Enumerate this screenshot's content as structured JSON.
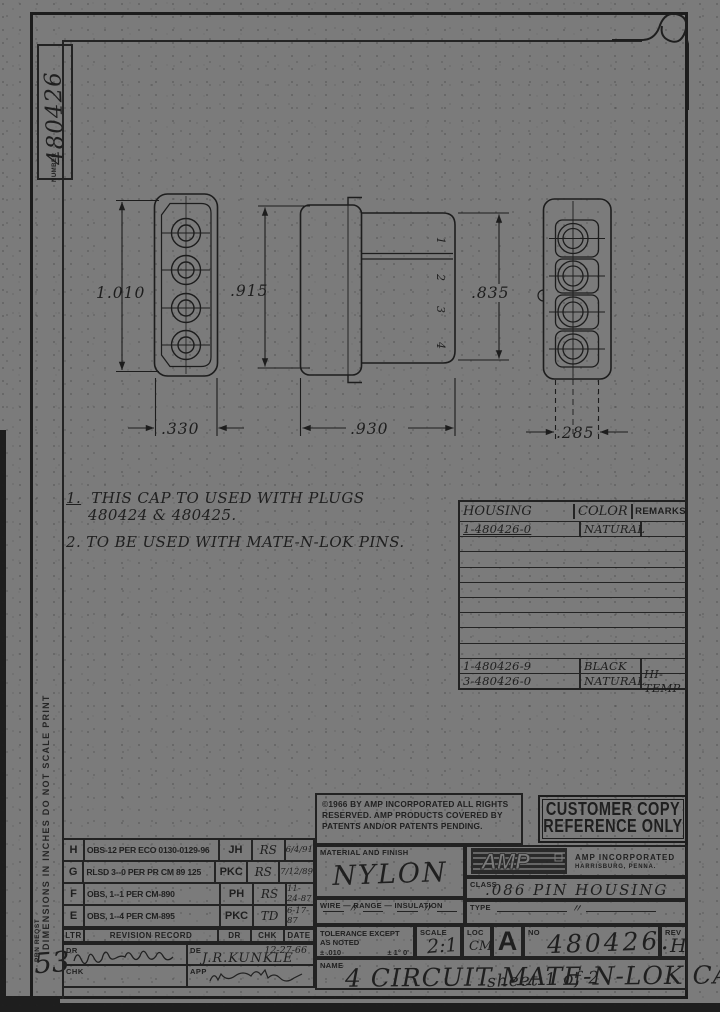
{
  "sheet": {
    "number_label": "NUMBER",
    "part_number": "480426",
    "margin_note": "DIMENSIONS IN INCHES  DO NOT SCALE PRINT",
    "print_note": "PRN REQST",
    "page_number": "53"
  },
  "drawing": {
    "dimensions": {
      "front_height": "1.010",
      "front_width": ".330",
      "side_height": ".915",
      "side_width": ".930",
      "body_height": ".835",
      "rear_width": ".285"
    },
    "pin_numbers": [
      "1",
      "2",
      "3",
      "4"
    ]
  },
  "notes": {
    "n1_num": "1.",
    "n1_line1": "THIS CAP TO USED WITH PLUGS",
    "n1_line2": "480424 & 480425.",
    "n2_num": "2.",
    "n2_line1": "TO BE USED WITH MATE-N-LOK PINS."
  },
  "housing_table": {
    "headers": [
      "HOUSING",
      "COLOR",
      "REMARKS"
    ],
    "rows": [
      {
        "housing": "1-480426-0",
        "color": "NATURAL",
        "remarks": ""
      },
      {
        "housing": "",
        "color": "",
        "remarks": ""
      },
      {
        "housing": "",
        "color": "",
        "remarks": ""
      },
      {
        "housing": "",
        "color": "",
        "remarks": ""
      },
      {
        "housing": "",
        "color": "",
        "remarks": ""
      },
      {
        "housing": "",
        "color": "",
        "remarks": ""
      },
      {
        "housing": "",
        "color": "",
        "remarks": ""
      },
      {
        "housing": "",
        "color": "",
        "remarks": ""
      },
      {
        "housing": "",
        "color": "",
        "remarks": ""
      },
      {
        "housing": "1-480426-9",
        "color": "BLACK",
        "remarks": ""
      },
      {
        "housing": "3-480426-0",
        "color": "NATURAL",
        "remarks": "HI-TEMP"
      }
    ]
  },
  "revision_block": {
    "header": {
      "ltr": "LTR",
      "record": "REVISION RECORD",
      "dr": "DR",
      "chk": "CHK",
      "date": "DATE"
    },
    "rows": [
      {
        "ltr": "H",
        "desc": "OBS-12 PER ECO 0130-0129-96",
        "dr": "JH",
        "chk": "RS",
        "date": "6/4/91"
      },
      {
        "ltr": "G",
        "desc": "RLSD 3--0 PER PR CM 89 125",
        "dr": "PKC",
        "chk": "RS",
        "date": "7/12/89"
      },
      {
        "ltr": "F",
        "desc": "OBS, 1--1 PER CM-890",
        "dr": "PH",
        "chk": "RS",
        "date": "11-24-87"
      },
      {
        "ltr": "E",
        "desc": "OBS, 1--4 PER CM-895",
        "dr": "PKC",
        "chk": "TD",
        "date": "6-17-87"
      }
    ],
    "dr_label": "DR",
    "chk_label": "CHK",
    "de_label": "DE",
    "app_label": "APP",
    "de_name": "J.R.KUNKLE",
    "de_date": "12-27-66"
  },
  "title_block": {
    "copyright_line1": "©1966 BY AMP INCORPORATED  ALL RIGHTS",
    "copyright_line2": "RESERVED. AMP PRODUCTS COVERED BY",
    "copyright_line3": "PATENTS AND/OR PATENTS PENDING.",
    "stamp_line1": "CUSTOMER COPY",
    "stamp_line2": "REFERENCE ONLY",
    "material_label": "MATERIAL AND FINISH",
    "material_value": "NYLON",
    "logo_text": "AMP",
    "company_name": "AMP INCORPORATED",
    "company_city": "HARRISBURG, PENNA.",
    "class_label": "CLASS",
    "class_value": ".086 PIN HOUSING",
    "wire_label": "WIRE — RANGE — INSULATION",
    "wire_ditto_1": "〃",
    "wire_ditto_2": "〃",
    "type_label": "TYPE",
    "type_ditto": "〃",
    "tol_line1": "TOLERANCE EXCEPT",
    "tol_line2": "AS NOTED",
    "tol_line3": "± .010",
    "tol_angle": "± 1° 0'",
    "scale_label": "SCALE",
    "scale_value": "2:1",
    "loc_label": "LOC",
    "loc_value": "CM",
    "size_letter": "A",
    "no_label": "NO",
    "drawing_number": "480426.",
    "rev_label": "REV",
    "rev_value": "H",
    "name_label": "NAME",
    "name_value": "4 CIRCUIT MATE-N-LOK CAP",
    "sheet_note": "sheet 1 of 2"
  },
  "colors": {
    "paper": "#7b7b7b",
    "ink": "#1d1d1d"
  }
}
